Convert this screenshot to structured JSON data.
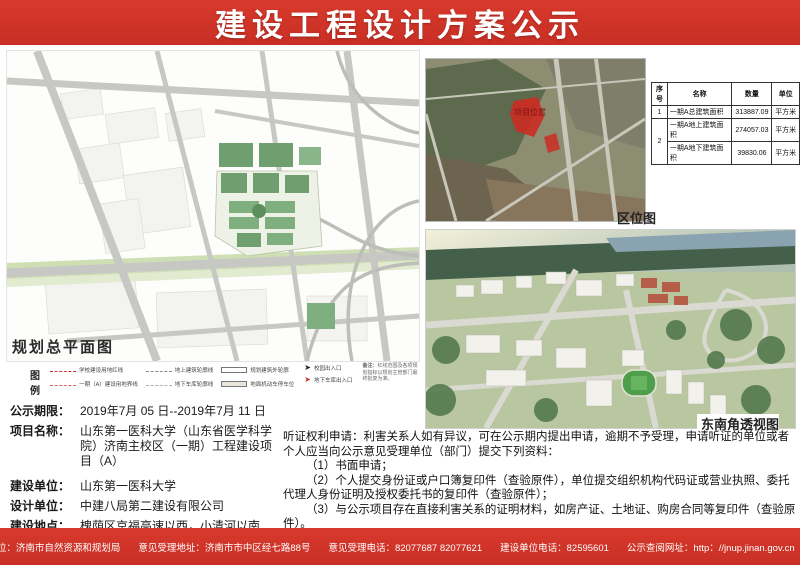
{
  "header": {
    "title": "建设工程设计方案公示"
  },
  "site_plan": {
    "label": "规划总平面图",
    "legend_title": "图例",
    "legend": [
      {
        "sym": "red-dash",
        "label": "学校建设用地红线"
      },
      {
        "sym": "gray-dash",
        "label": "地上建筑轮廓线"
      },
      {
        "sym": "box",
        "label": "规划建筑外轮廓"
      },
      {
        "sym": "red-dashdot",
        "label": "一期（A）建设用地界线"
      },
      {
        "sym": "gray-dash2",
        "label": "地下车库轮廓线"
      },
      {
        "sym": "box-fill",
        "label": "地面机动车停车位"
      }
    ],
    "arrow_black_label": "校园出入口",
    "arrow_red_label": "地下车库出入口",
    "note_label": "备注：",
    "note_text": "红线范围及各项规划指标以规划主管部门最终批复为准。"
  },
  "location_map": {
    "label": "区位图",
    "marker_label": "项目位置"
  },
  "table": {
    "headers": [
      "序号",
      "名称",
      "数量",
      "单位"
    ],
    "rows": [
      [
        "1",
        "一期A总建筑面积",
        "313887.09",
        "平方米"
      ],
      [
        "2",
        "一期A地上建筑面积",
        "274057.03",
        "平方米"
      ],
      [
        "2",
        "一期A地下建筑面积",
        "39830.06",
        "平方米"
      ]
    ]
  },
  "perspective": {
    "label": "东南角透视图"
  },
  "info": {
    "rows": [
      {
        "label": "公示期限：",
        "value": "2019年7月 05 日--2019年7月 11 日"
      },
      {
        "label": "项目名称：",
        "value": "山东第一医科大学（山东省医学科学院）济南主校区（一期）工程建设项目（A）"
      },
      {
        "label": "建设单位：",
        "value": "山东第一医科大学"
      },
      {
        "label": "设计单位：",
        "value": "中建八局第二建设有限公司"
      },
      {
        "label": "建设地点：",
        "value": "槐荫区京福高速以西，小清河以南"
      }
    ]
  },
  "hearing": {
    "p1": "听证权利申请：利害关系人如有异议，可在公示期内提出申请，逾期不予受理，申请听证的单位或者个人应当向公示意见受理单位（部门）提交下列资料：",
    "p2": "（1）书面申请；",
    "p3": "（2）个人提交身份证或户口簿复印件（查验原件），单位提交组织机构代码证或营业执照、委托代理人身份证明及授权委托书的复印件（查验原件）；",
    "p4": "（3）与公示项目存在直接利害关系的证明材料，如房产证、土地证、购房合同等复印件（查验原件）。",
    "p5": "济南市自然资源和规划局对听证申请及相关材料进行审查后，做出是否听证的决定并书面告知听证申请人。"
  },
  "footer": {
    "seg1": "意见受理单位：济南市自然资源和规划局",
    "seg2": "意见受理地址：济南市市中区经七路88号",
    "seg3": "意见受理电话：82077687  82077621",
    "seg4": "建设单位电话：82595601",
    "seg5": "公示查阅网址：http：//jnup.jinan.gov.cn",
    "qr_caption": "济南市自然资源和规划局 公示信息二维码"
  },
  "colors": {
    "banner_red": "#cf342a"
  }
}
